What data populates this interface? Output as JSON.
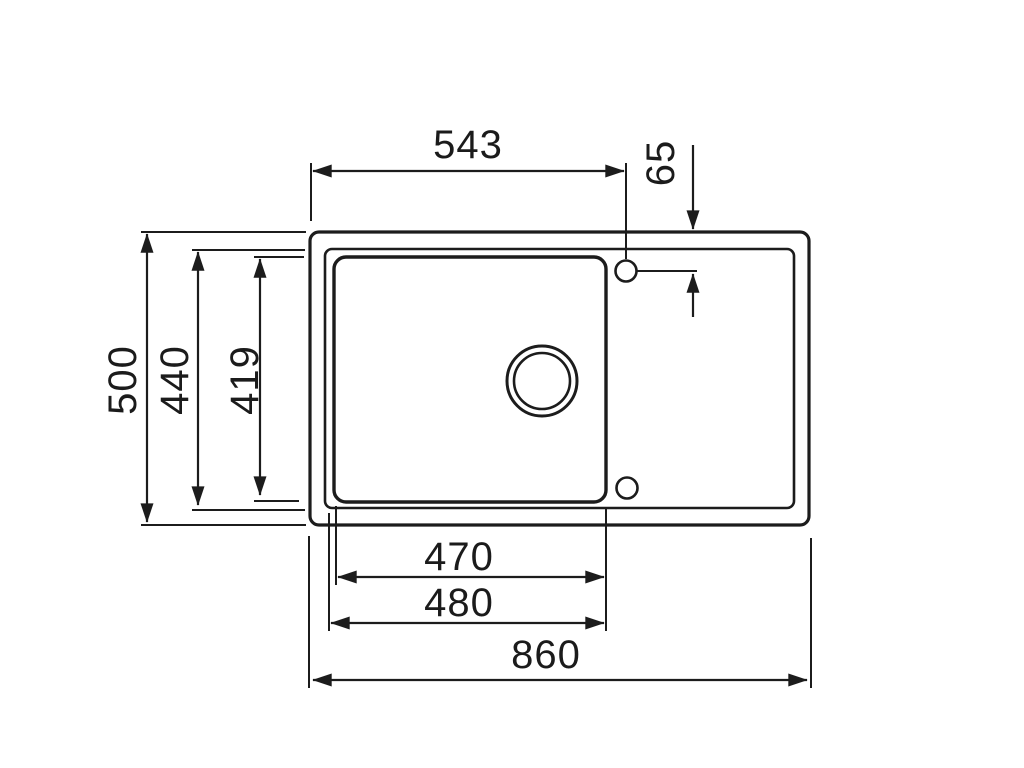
{
  "drawing": {
    "kind": "technical-dimension-drawing",
    "view": "sink-top-view",
    "ink_color": "#1c1c1c",
    "background_color": "#ffffff",
    "labels": {
      "tap_hole_x_offset": "543",
      "tap_hole_y_offset": "65",
      "overall_depth": "500",
      "rim_depth": "440",
      "bowl_depth": "419",
      "bowl_width_inner": "470",
      "bowl_width_outer": "480",
      "overall_width": "860"
    }
  }
}
